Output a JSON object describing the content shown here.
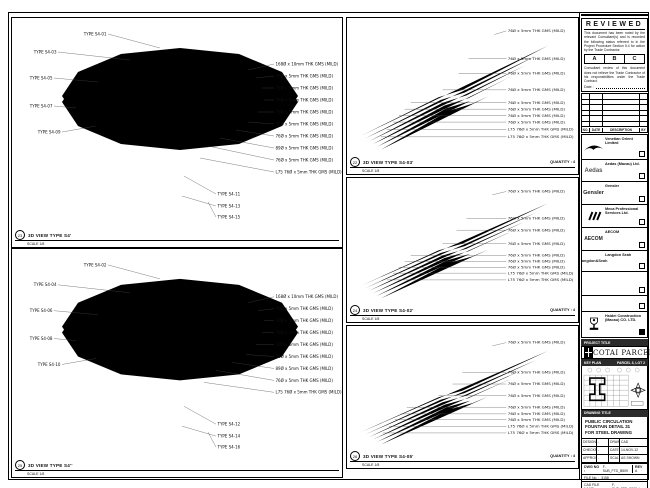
{
  "panels": {
    "left_top": {
      "ref": "23",
      "title": "3D VIEW TYPE S4'",
      "scale": "SCALE 1/8",
      "ann": [
        {
          "t": "TYPE S4-01",
          "x": 96,
          "y": 16,
          "lx": 148,
          "ly": 30,
          "a": "end"
        },
        {
          "t": "TYPE S4-03",
          "x": 46,
          "y": 34,
          "lx": 118,
          "ly": 42,
          "a": "end"
        },
        {
          "t": "TYPE S4-05",
          "x": 42,
          "y": 60,
          "lx": 86,
          "ly": 64,
          "a": "end"
        },
        {
          "t": "TYPE S4-07",
          "x": 42,
          "y": 88,
          "lx": 64,
          "ly": 90,
          "a": "end"
        },
        {
          "t": "TYPE S4-09",
          "x": 50,
          "y": 114,
          "lx": 84,
          "ly": 108,
          "a": "end"
        },
        {
          "t": "168Ø x 10mm THK GMS (MILD)",
          "x": 262,
          "y": 46,
          "lx": 236,
          "ly": 52
        },
        {
          "t": "76Ø x 5mm THK GMS (MILD)",
          "x": 262,
          "y": 58,
          "lx": 244,
          "ly": 60
        },
        {
          "t": "76Ø x 5mm THK GMS (MILD)",
          "x": 262,
          "y": 70,
          "lx": 250,
          "ly": 70
        },
        {
          "t": "76Ø x 5mm THK GMS (MILD)",
          "x": 262,
          "y": 82,
          "lx": 252,
          "ly": 82
        },
        {
          "t": "76Ø x 5mm THK GMS (MILD)",
          "x": 262,
          "y": 94,
          "lx": 246,
          "ly": 94
        },
        {
          "t": "76Ø x 5mm THK GMS (MILD)",
          "x": 262,
          "y": 106,
          "lx": 236,
          "ly": 104
        },
        {
          "t": "76Ø x 5mm THK GMS (MILD)",
          "x": 262,
          "y": 118,
          "lx": 224,
          "ly": 112
        },
        {
          "t": "89Ø x 5mm THK GMS (MILD)",
          "x": 262,
          "y": 130,
          "lx": 208,
          "ly": 120
        },
        {
          "t": "76Ø x 5mm THK GMS (MILD)",
          "x": 262,
          "y": 142,
          "lx": 196,
          "ly": 128
        },
        {
          "t": "L75 76Ø x 5mm THK GMS (MILD)",
          "x": 262,
          "y": 154,
          "lx": 188,
          "ly": 140
        },
        {
          "t": "TYPE S4-11",
          "x": 204,
          "y": 176,
          "lx": 172,
          "ly": 158
        },
        {
          "t": "TYPE S4-13",
          "x": 204,
          "y": 188,
          "lx": 170,
          "ly": 178
        },
        {
          "t": "TYPE S4-15",
          "x": 204,
          "y": 199,
          "lx": 196,
          "ly": 184
        }
      ]
    },
    "left_bottom": {
      "ref": "25",
      "title": "3D VIEW TYPE S4''",
      "scale": "SCALE 1/8",
      "ann": [
        {
          "t": "TYPE S4-02",
          "x": 96,
          "y": 16,
          "lx": 148,
          "ly": 30,
          "a": "end"
        },
        {
          "t": "TYPE S4-04",
          "x": 46,
          "y": 36,
          "lx": 118,
          "ly": 44,
          "a": "end"
        },
        {
          "t": "TYPE S4-06",
          "x": 42,
          "y": 62,
          "lx": 86,
          "ly": 66,
          "a": "end"
        },
        {
          "t": "TYPE S4-08",
          "x": 42,
          "y": 90,
          "lx": 64,
          "ly": 92,
          "a": "end"
        },
        {
          "t": "TYPE S4-10",
          "x": 50,
          "y": 116,
          "lx": 84,
          "ly": 110,
          "a": "end"
        },
        {
          "t": "168Ø x 10mm THK GMS (MILD)",
          "x": 262,
          "y": 48,
          "lx": 236,
          "ly": 54
        },
        {
          "t": "76Ø x 5mm THK GMS (MILD)",
          "x": 262,
          "y": 60,
          "lx": 246,
          "ly": 62
        },
        {
          "t": "76Ø x 5mm THK GMS (MILD)",
          "x": 262,
          "y": 72,
          "lx": 252,
          "ly": 72
        },
        {
          "t": "76Ø x 5mm THK GMS (MILD)",
          "x": 262,
          "y": 84,
          "lx": 250,
          "ly": 84
        },
        {
          "t": "76Ø x 5mm THK GMS (MILD)",
          "x": 262,
          "y": 96,
          "lx": 244,
          "ly": 96
        },
        {
          "t": "76Ø x 5mm THK GMS (MILD)",
          "x": 262,
          "y": 108,
          "lx": 234,
          "ly": 106
        },
        {
          "t": "89Ø x 5mm THK GMS (MILD)",
          "x": 262,
          "y": 120,
          "lx": 220,
          "ly": 114
        },
        {
          "t": "76Ø x 5mm THK GMS (MILD)",
          "x": 262,
          "y": 132,
          "lx": 204,
          "ly": 122
        },
        {
          "t": "L75 76Ø x 5mm THK GMS (MILD)",
          "x": 262,
          "y": 144,
          "lx": 192,
          "ly": 134
        },
        {
          "t": "TYPE S4-12",
          "x": 204,
          "y": 176,
          "lx": 172,
          "ly": 158
        },
        {
          "t": "TYPE S4-14",
          "x": 204,
          "y": 188,
          "lx": 170,
          "ly": 178
        },
        {
          "t": "TYPE S4-16",
          "x": 204,
          "y": 199,
          "lx": 196,
          "ly": 184
        }
      ]
    },
    "mid1": {
      "ref": "22",
      "title": "3D VIEW TYPE S4-03'",
      "scale": "SCALE 1/8",
      "quantity": "QUANTITY : 4",
      "ann": [
        {
          "t": "76Ø x 5mm THK GMS (MILD)",
          "x": 160,
          "y": 14,
          "lx": 148,
          "ly": 18
        },
        {
          "t": "76Ø x 5mm THK GMS (MILD)",
          "x": 160,
          "y": 44,
          "lx": 122,
          "ly": 44
        },
        {
          "t": "76Ø x 5mm THK GMS (MILD)",
          "x": 160,
          "y": 60,
          "lx": 112,
          "ly": 60
        },
        {
          "t": "76Ø x 5mm THK GMS (MILD)",
          "x": 160,
          "y": 78,
          "lx": 96,
          "ly": 78
        },
        {
          "t": "76Ø x 5mm THK GMS (MILD)",
          "x": 160,
          "y": 92,
          "lx": 64,
          "ly": 92
        },
        {
          "t": "76Ø x 5mm THK GMS (MILD)",
          "x": 160,
          "y": 99,
          "lx": 58,
          "ly": 99
        },
        {
          "t": "76Ø x 5mm THK GMS (MILD)",
          "x": 160,
          "y": 106,
          "lx": 52,
          "ly": 106
        },
        {
          "t": "76Ø x 5mm THK GMS (MILD)",
          "x": 160,
          "y": 113,
          "lx": 46,
          "ly": 113
        },
        {
          "t": "L75 76Ø x 5mm THK GMS (MILD)",
          "x": 160,
          "y": 121,
          "lx": 40,
          "ly": 121
        },
        {
          "t": "L75 76Ø x 5mm THK GMS (MILD)",
          "x": 160,
          "y": 129,
          "lx": 34,
          "ly": 129
        }
      ]
    },
    "mid2": {
      "ref": "24",
      "title": "3D VIEW TYPE S4-02'",
      "scale": "SCALE 1/8",
      "quantity": "QUANTITY : 4",
      "ann": [
        {
          "t": "76Ø x 5mm THK GMS (MILD)",
          "x": 160,
          "y": 16,
          "lx": 146,
          "ly": 20
        },
        {
          "t": "76Ø x 5mm THK GMS (MILD)",
          "x": 160,
          "y": 48,
          "lx": 120,
          "ly": 48
        },
        {
          "t": "76Ø x 5mm THK GMS (MILD)",
          "x": 160,
          "y": 62,
          "lx": 110,
          "ly": 62
        },
        {
          "t": "76Ø x 5mm THK GMS (MILD)",
          "x": 160,
          "y": 78,
          "lx": 96,
          "ly": 78
        },
        {
          "t": "76Ø x 5mm THK GMS (MILD)",
          "x": 160,
          "y": 92,
          "lx": 64,
          "ly": 92
        },
        {
          "t": "76Ø x 5mm THK GMS (MILD)",
          "x": 160,
          "y": 99,
          "lx": 58,
          "ly": 99
        },
        {
          "t": "76Ø x 5mm THK GMS (MILD)",
          "x": 160,
          "y": 106,
          "lx": 52,
          "ly": 106
        },
        {
          "t": "L75 76Ø x 5mm THK GMS (MILD)",
          "x": 160,
          "y": 113,
          "lx": 46,
          "ly": 113
        },
        {
          "t": "L75 76Ø x 5mm THK GMS (MILD)",
          "x": 160,
          "y": 121,
          "lx": 40,
          "ly": 121
        }
      ]
    },
    "mid3": {
      "ref": "26",
      "title": "3D VIEW TYPE S4-05'",
      "scale": "SCALE 1/8",
      "quantity": "QUANTITY : 4",
      "ann": [
        {
          "t": "76Ø x 5mm THK GMS (MILD)",
          "x": 160,
          "y": 20,
          "lx": 146,
          "ly": 24
        },
        {
          "t": "76Ø x 5mm THK GMS (MILD)",
          "x": 160,
          "y": 56,
          "lx": 116,
          "ly": 56
        },
        {
          "t": "76Ø x 5mm THK GMS (MILD)",
          "x": 160,
          "y": 70,
          "lx": 106,
          "ly": 70
        },
        {
          "t": "76Ø x 5mm THK GMS (MILD)",
          "x": 160,
          "y": 84,
          "lx": 92,
          "ly": 84
        },
        {
          "t": "76Ø x 5mm THK GMS (MILD)",
          "x": 160,
          "y": 98,
          "lx": 60,
          "ly": 98
        },
        {
          "t": "76Ø x 5mm THK GMS (MILD)",
          "x": 160,
          "y": 106,
          "lx": 54,
          "ly": 106
        },
        {
          "t": "76Ø x 5mm THK GMS (MILD)",
          "x": 160,
          "y": 113,
          "lx": 48,
          "ly": 113
        },
        {
          "t": "L75 76Ø x 5mm THK GMS (MILD)",
          "x": 160,
          "y": 121,
          "lx": 42,
          "ly": 121
        },
        {
          "t": "L75 76Ø x 5mm THK GMS (MILD)",
          "x": 160,
          "y": 129,
          "lx": 36,
          "ly": 129
        }
      ]
    }
  },
  "stamp": {
    "title": "REVIEWED",
    "note1": "This document has been noted by the relevant Consultant(s) and is recorded the following status referred to in the Project Procedure Section 5.4 for action by the Trade Contractor.",
    "options": [
      "A",
      "B",
      "C"
    ],
    "note2": "Consultant review of this document does not relieve the Trade Contractor of his responsibilities under the Trade Contract.",
    "date_label": "Date :"
  },
  "revisions": {
    "headers": [
      "NO.",
      "DATE",
      "DESCRIPTION",
      "BY"
    ]
  },
  "consultants": [
    {
      "name": "Venetian Orient Limited",
      "logo": ""
    },
    {
      "name": "Aedas (Macau) Ltd.",
      "logo": "Aedas"
    },
    {
      "name": "Gensler",
      "logo": "Gensler"
    },
    {
      "name": "Meca Professional Services Ltd.",
      "logo": ""
    },
    {
      "name": "AECOM",
      "logo": "AECOM"
    },
    {
      "name": "Langdon Seah",
      "logo": "Langdon&Seah"
    },
    {
      "name": "",
      "logo": ""
    },
    {
      "name": "",
      "logo": ""
    },
    {
      "name": "Hsidei Construction (Macau) CO. LTD.",
      "logo": ""
    }
  ],
  "project": {
    "label": "PROJECT TITLE",
    "name": "COTAI PARCEL 3"
  },
  "keyplan": {
    "label": "KEY PLAN",
    "sub": "PARCEL 3, LOT 2"
  },
  "drawing": {
    "label": "DRAWING TITLE",
    "line1": "PUBLIC CIRCULATION",
    "line2": "FOUNTAIN DETAIL 31",
    "line3": "FOR STEEL DRAWING"
  },
  "credits": {
    "designed_label": "DESIGNED",
    "designed": "-",
    "drawn_label": "DRAWN",
    "drawn": "CAD",
    "checked_label": "CHECKED",
    "checked": "-",
    "date_label": "DATE",
    "date": "14-NOV-12",
    "approved_label": "APPROVED",
    "approved": "-",
    "scale_label": "SCALE",
    "scale": "AS SHOWN"
  },
  "dwg": {
    "no_label": "DWG NO :",
    "no": "F-SUB_FTD_B509",
    "rev_label": "REV",
    "rev": "A",
    "file_label": "FILE No. :",
    "file": "3158",
    "cad_label": "CAD FILE NAME :",
    "cad": "F-SUB_FTD_B509.dwg",
    "ref_label": "REFERENCE DWG FILE NAME :"
  }
}
